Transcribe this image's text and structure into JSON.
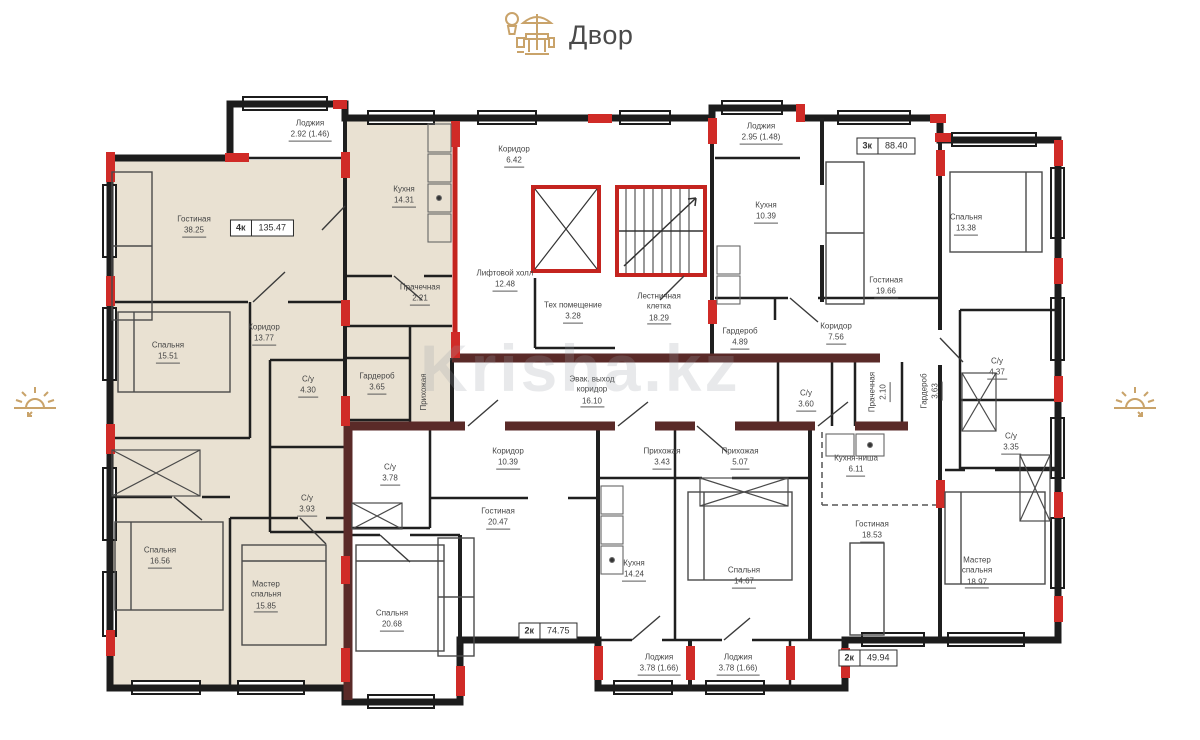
{
  "header": {
    "label": "Двор",
    "icon": "patio-table-icon"
  },
  "side_icons": {
    "left": "sunrise-icon",
    "right": "sunrise-icon"
  },
  "watermark": {
    "text": "Krisha.kz"
  },
  "colors": {
    "wall_black": "#1c1c1c",
    "accent_red": "#d02b27",
    "corridor_maroon": "#5a2a28",
    "apartment_fill": "#e9e1d2",
    "icon_tan": "#c9a36a",
    "label_text": "#454545"
  },
  "plan": {
    "unit_badges": [
      {
        "unit": "4к",
        "area": "135.47",
        "x": 262,
        "y": 228
      },
      {
        "unit": "3к",
        "area": "88.40",
        "x": 886,
        "y": 146
      },
      {
        "unit": "2к",
        "area": "74.75",
        "x": 548,
        "y": 631
      },
      {
        "unit": "2к",
        "area": "49.94",
        "x": 868,
        "y": 658
      }
    ],
    "rooms": [
      {
        "name": "Лоджия",
        "area": "2.92 (1.46)",
        "x": 310,
        "y": 130
      },
      {
        "name": "Гостиная",
        "area": "38.25",
        "x": 194,
        "y": 226
      },
      {
        "name": "Кухня",
        "area": "14.31",
        "x": 404,
        "y": 196
      },
      {
        "name": "Прачечная",
        "area": "2.21",
        "x": 420,
        "y": 294
      },
      {
        "name": "Коридор",
        "area": "13.77",
        "x": 264,
        "y": 334
      },
      {
        "name": "Спальня",
        "area": "15.51",
        "x": 168,
        "y": 352
      },
      {
        "name": "С/у",
        "area": "4.30",
        "x": 308,
        "y": 386
      },
      {
        "name": "Гардероб",
        "area": "3.65",
        "x": 377,
        "y": 383
      },
      {
        "name": "Прихожая",
        "area": "",
        "x": 424,
        "y": 392,
        "rotate": true
      },
      {
        "name": "С/у",
        "area": "3.93",
        "x": 307,
        "y": 505
      },
      {
        "name": "Спальня",
        "area": "16.56",
        "x": 160,
        "y": 557
      },
      {
        "name": "Мастер\nспальня",
        "area": "15.85",
        "x": 266,
        "y": 596
      },
      {
        "name": "Коридор",
        "area": "6.42",
        "x": 514,
        "y": 156
      },
      {
        "name": "Лифтовой холл",
        "area": "12.48",
        "x": 505,
        "y": 280
      },
      {
        "name": "Тех помещение",
        "area": "3.28",
        "x": 573,
        "y": 312
      },
      {
        "name": "Лестничная\nклетка",
        "area": "18.29",
        "x": 659,
        "y": 308
      },
      {
        "name": "Эвак. выход\nкоридор",
        "area": "16.10",
        "x": 592,
        "y": 391
      },
      {
        "name": "Лоджия",
        "area": "2.95 (1.48)",
        "x": 761,
        "y": 133
      },
      {
        "name": "Кухня",
        "area": "10.39",
        "x": 766,
        "y": 212
      },
      {
        "name": "Гостиная",
        "area": "19.66",
        "x": 886,
        "y": 287
      },
      {
        "name": "Спальня",
        "area": "13.38",
        "x": 966,
        "y": 224
      },
      {
        "name": "Гардероб",
        "area": "4.89",
        "x": 740,
        "y": 338
      },
      {
        "name": "Коридор",
        "area": "7.56",
        "x": 836,
        "y": 333
      },
      {
        "name": "С/у",
        "area": "3.60",
        "x": 806,
        "y": 400
      },
      {
        "name": "Прачечная",
        "area": "2.10",
        "x": 879,
        "y": 392,
        "rotate": true
      },
      {
        "name": "Гардероб",
        "area": "3.63",
        "x": 931,
        "y": 391,
        "rotate": true
      },
      {
        "name": "С/у",
        "area": "4.37",
        "x": 997,
        "y": 368
      },
      {
        "name": "С/у",
        "area": "3.35",
        "x": 1011,
        "y": 443
      },
      {
        "name": "С/у",
        "area": "3.78",
        "x": 390,
        "y": 474
      },
      {
        "name": "Коридор",
        "area": "10.39",
        "x": 508,
        "y": 458
      },
      {
        "name": "Гостиная",
        "area": "20.47",
        "x": 498,
        "y": 518
      },
      {
        "name": "Спальня",
        "area": "20.68",
        "x": 392,
        "y": 620
      },
      {
        "name": "Кухня",
        "area": "14.24",
        "x": 634,
        "y": 570
      },
      {
        "name": "Прихожая",
        "area": "3.43",
        "x": 662,
        "y": 458
      },
      {
        "name": "Прихожая",
        "area": "5.07",
        "x": 740,
        "y": 458
      },
      {
        "name": "Спальня",
        "area": "14.67",
        "x": 744,
        "y": 577
      },
      {
        "name": "Кухня-ниша",
        "area": "6.11",
        "x": 856,
        "y": 465
      },
      {
        "name": "Гостиная",
        "area": "18.53",
        "x": 872,
        "y": 531
      },
      {
        "name": "Мастер\nспальня",
        "area": "18.97",
        "x": 977,
        "y": 572
      },
      {
        "name": "Лоджия",
        "area": "3.78 (1.66)",
        "x": 659,
        "y": 664
      },
      {
        "name": "Лоджия",
        "area": "3.78 (1.66)",
        "x": 738,
        "y": 664
      }
    ]
  }
}
